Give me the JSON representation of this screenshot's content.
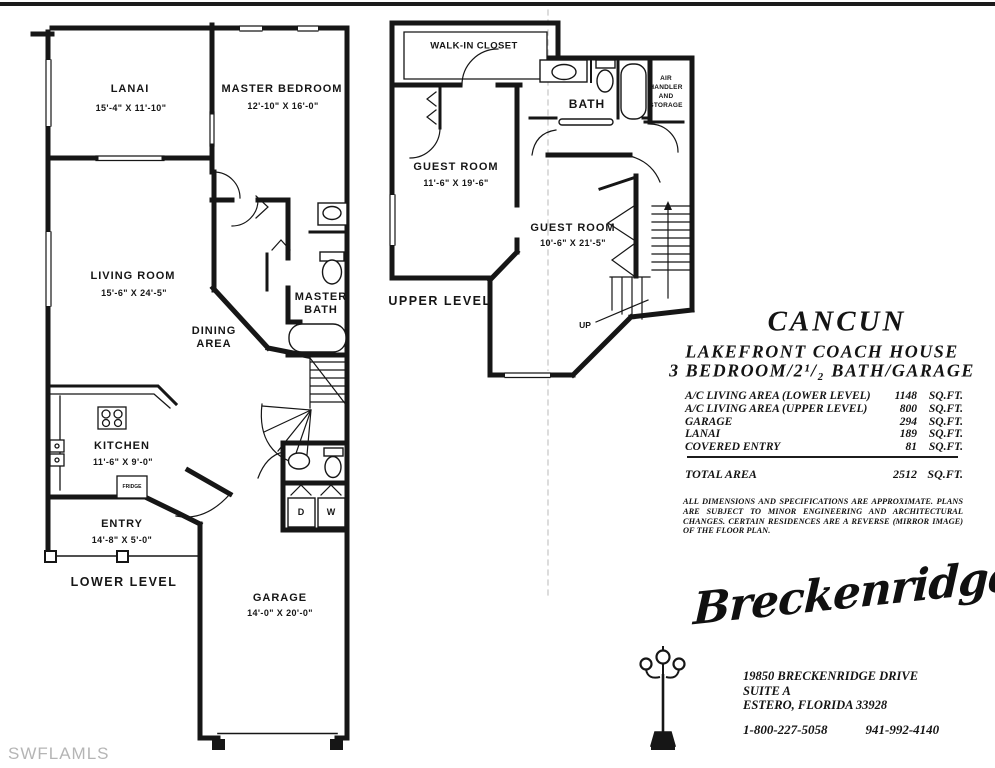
{
  "page": {
    "watermark": "SWFLAMLS"
  },
  "lower_level": {
    "level_label": "LOWER LEVEL",
    "rooms": {
      "lanai": {
        "name": "LANAI",
        "dims": "15'-4\" X 11'-10\""
      },
      "master_bedroom": {
        "name": "MASTER BEDROOM",
        "dims": "12'-10\" X 16'-0\""
      },
      "living_room": {
        "name": "LIVING ROOM",
        "dims": "15'-6\" X 24'-5\""
      },
      "dining_line1": "DINING",
      "dining_line2": "AREA",
      "master_bath_line1": "MASTER",
      "master_bath_line2": "BATH",
      "kitchen": {
        "name": "KITCHEN",
        "dims": "11'-6\" X 9'-0\""
      },
      "fridge": "FRIDGE",
      "entry": {
        "name": "ENTRY",
        "dims": "14'-8\" X 5'-0\""
      },
      "garage": {
        "name": "GARAGE",
        "dims": "14'-0\" X 20'-0\""
      },
      "dryer": "D",
      "washer": "W"
    }
  },
  "upper_level": {
    "level_label": "UPPER LEVEL",
    "rooms": {
      "walk_in_closet": "WALK-IN CLOSET",
      "bath": "BATH",
      "air_handler_lines": [
        "AIR",
        "HANDLER",
        "AND",
        "STORAGE"
      ],
      "guest_room_1": {
        "name": "GUEST ROOM",
        "dims": "11'-6\" X 19'-6\""
      },
      "guest_room_2": {
        "name": "GUEST ROOM",
        "dims": "10'-6\" X 21'-5\""
      },
      "up_label": "UP"
    }
  },
  "info": {
    "plan_name": "CANCUN",
    "subtitle1": "LAKEFRONT COACH HOUSE",
    "subtitle2": "3 BEDROOM/2¹/₂ BATH/GARAGE",
    "areas": [
      {
        "label": "A/C LIVING AREA  (LOWER LEVEL)",
        "value": "1148",
        "unit": "SQ.FT."
      },
      {
        "label": "A/C LIVING AREA (UPPER LEVEL)",
        "value": "800",
        "unit": "SQ.FT."
      },
      {
        "label": "GARAGE",
        "value": "294",
        "unit": "SQ.FT."
      },
      {
        "label": "LANAI",
        "value": "189",
        "unit": "SQ.FT."
      },
      {
        "label": "COVERED ENTRY",
        "value": "81",
        "unit": "SQ.FT."
      }
    ],
    "total": {
      "label": "TOTAL AREA",
      "value": "2512",
      "unit": "SQ.FT."
    },
    "disclaimer": "ALL DIMENSIONS AND SPECIFICATIONS ARE APPROXIMATE.  PLANS ARE SUBJECT TO MINOR ENGINEERING AND ARCHITECTURAL CHANGES. CERTAIN RESIDENCES ARE A REVERSE  (MIRROR IMAGE) OF THE FLOOR PLAN.",
    "builder": {
      "logo_text": "Breckenridge",
      "address_line1": "19850 BRECKENRIDGE DRIVE",
      "address_line2": "SUITE A",
      "address_line3": "ESTERO, FLORIDA 33928",
      "phone1": "1-800-227-5058",
      "phone2": "941-992-4140"
    }
  }
}
